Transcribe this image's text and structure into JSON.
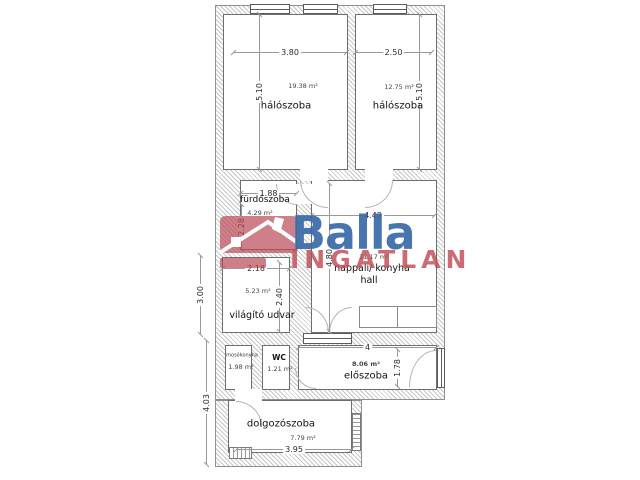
{
  "logo": {
    "brand": "Balla",
    "subbrand": "INGATLAN",
    "brand_color": "#3a6aa8",
    "accent_color": "#c04e58",
    "house_icon": "house-roof-icon"
  },
  "rooms": {
    "bedroom_left": {
      "name": "hálószoba",
      "area": "19.38 m²",
      "width": "3.80",
      "height": "5.10"
    },
    "bedroom_right": {
      "name": "hálószoba",
      "area": "12.75 m²",
      "width": "2.50",
      "height": "5.10"
    },
    "bathroom": {
      "name": "fürdőszoba",
      "area": "4.29 m²",
      "width": "1.88",
      "height": "2.28"
    },
    "light_court": {
      "name": "világító udvar",
      "area": "5.23 m²",
      "width": "2.18",
      "height": "2.40",
      "outer_height": "3.00"
    },
    "living": {
      "name": "nappali/ konyha",
      "name2": "hall",
      "area": "21.17 m²",
      "width": "4.42",
      "height": "4.80"
    },
    "laundry": {
      "name": "mosókonyha",
      "area": "1.98 m²"
    },
    "wc": {
      "name": "WC",
      "area": "1.21 m²"
    },
    "hallway": {
      "name": "előszoba",
      "area": "8.06 m²",
      "width": "4",
      "height": "1.78"
    },
    "study": {
      "name": "dolgozószoba",
      "area": "7.79 m²",
      "width": "3.95",
      "outer_height": "4.03"
    }
  }
}
